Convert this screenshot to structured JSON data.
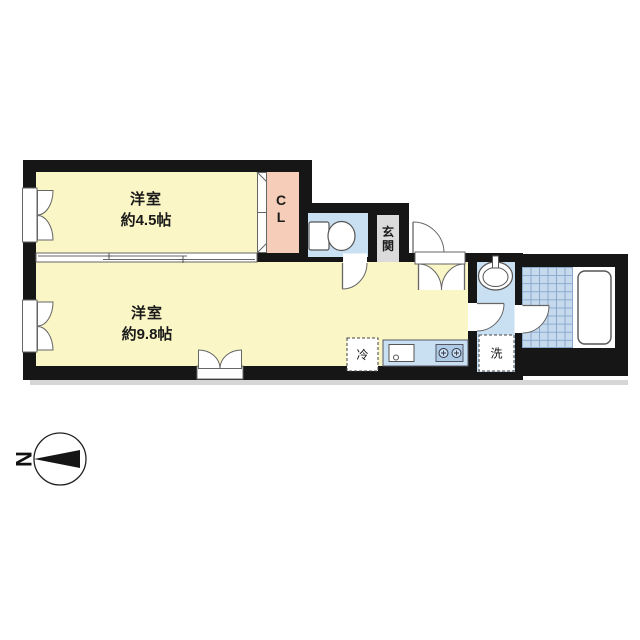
{
  "floor_plan": {
    "rooms": [
      {
        "label": "洋室",
        "size": "約4.5帖"
      },
      {
        "label": "洋室",
        "size": "約9.8帖"
      }
    ],
    "closet": {
      "line1": "C",
      "line2": "L"
    },
    "entrance": {
      "char1": "玄",
      "char2": "関"
    },
    "appliances": {
      "refrigerator": "冷",
      "washer": "洗"
    },
    "compass": {
      "north": "N"
    },
    "colors": {
      "wall": "#161616",
      "room_floor": "#FAF6C6",
      "closet_floor": "#F5CDB9",
      "wet_area_floor": "#C9DFF2",
      "tile_floor": "#C6DAEE",
      "tile_grid": "#8AA8CB",
      "entrance_floor": "#DBDBDB",
      "fixture_outline": "#666666",
      "shadow": "#D6D6D6"
    }
  }
}
